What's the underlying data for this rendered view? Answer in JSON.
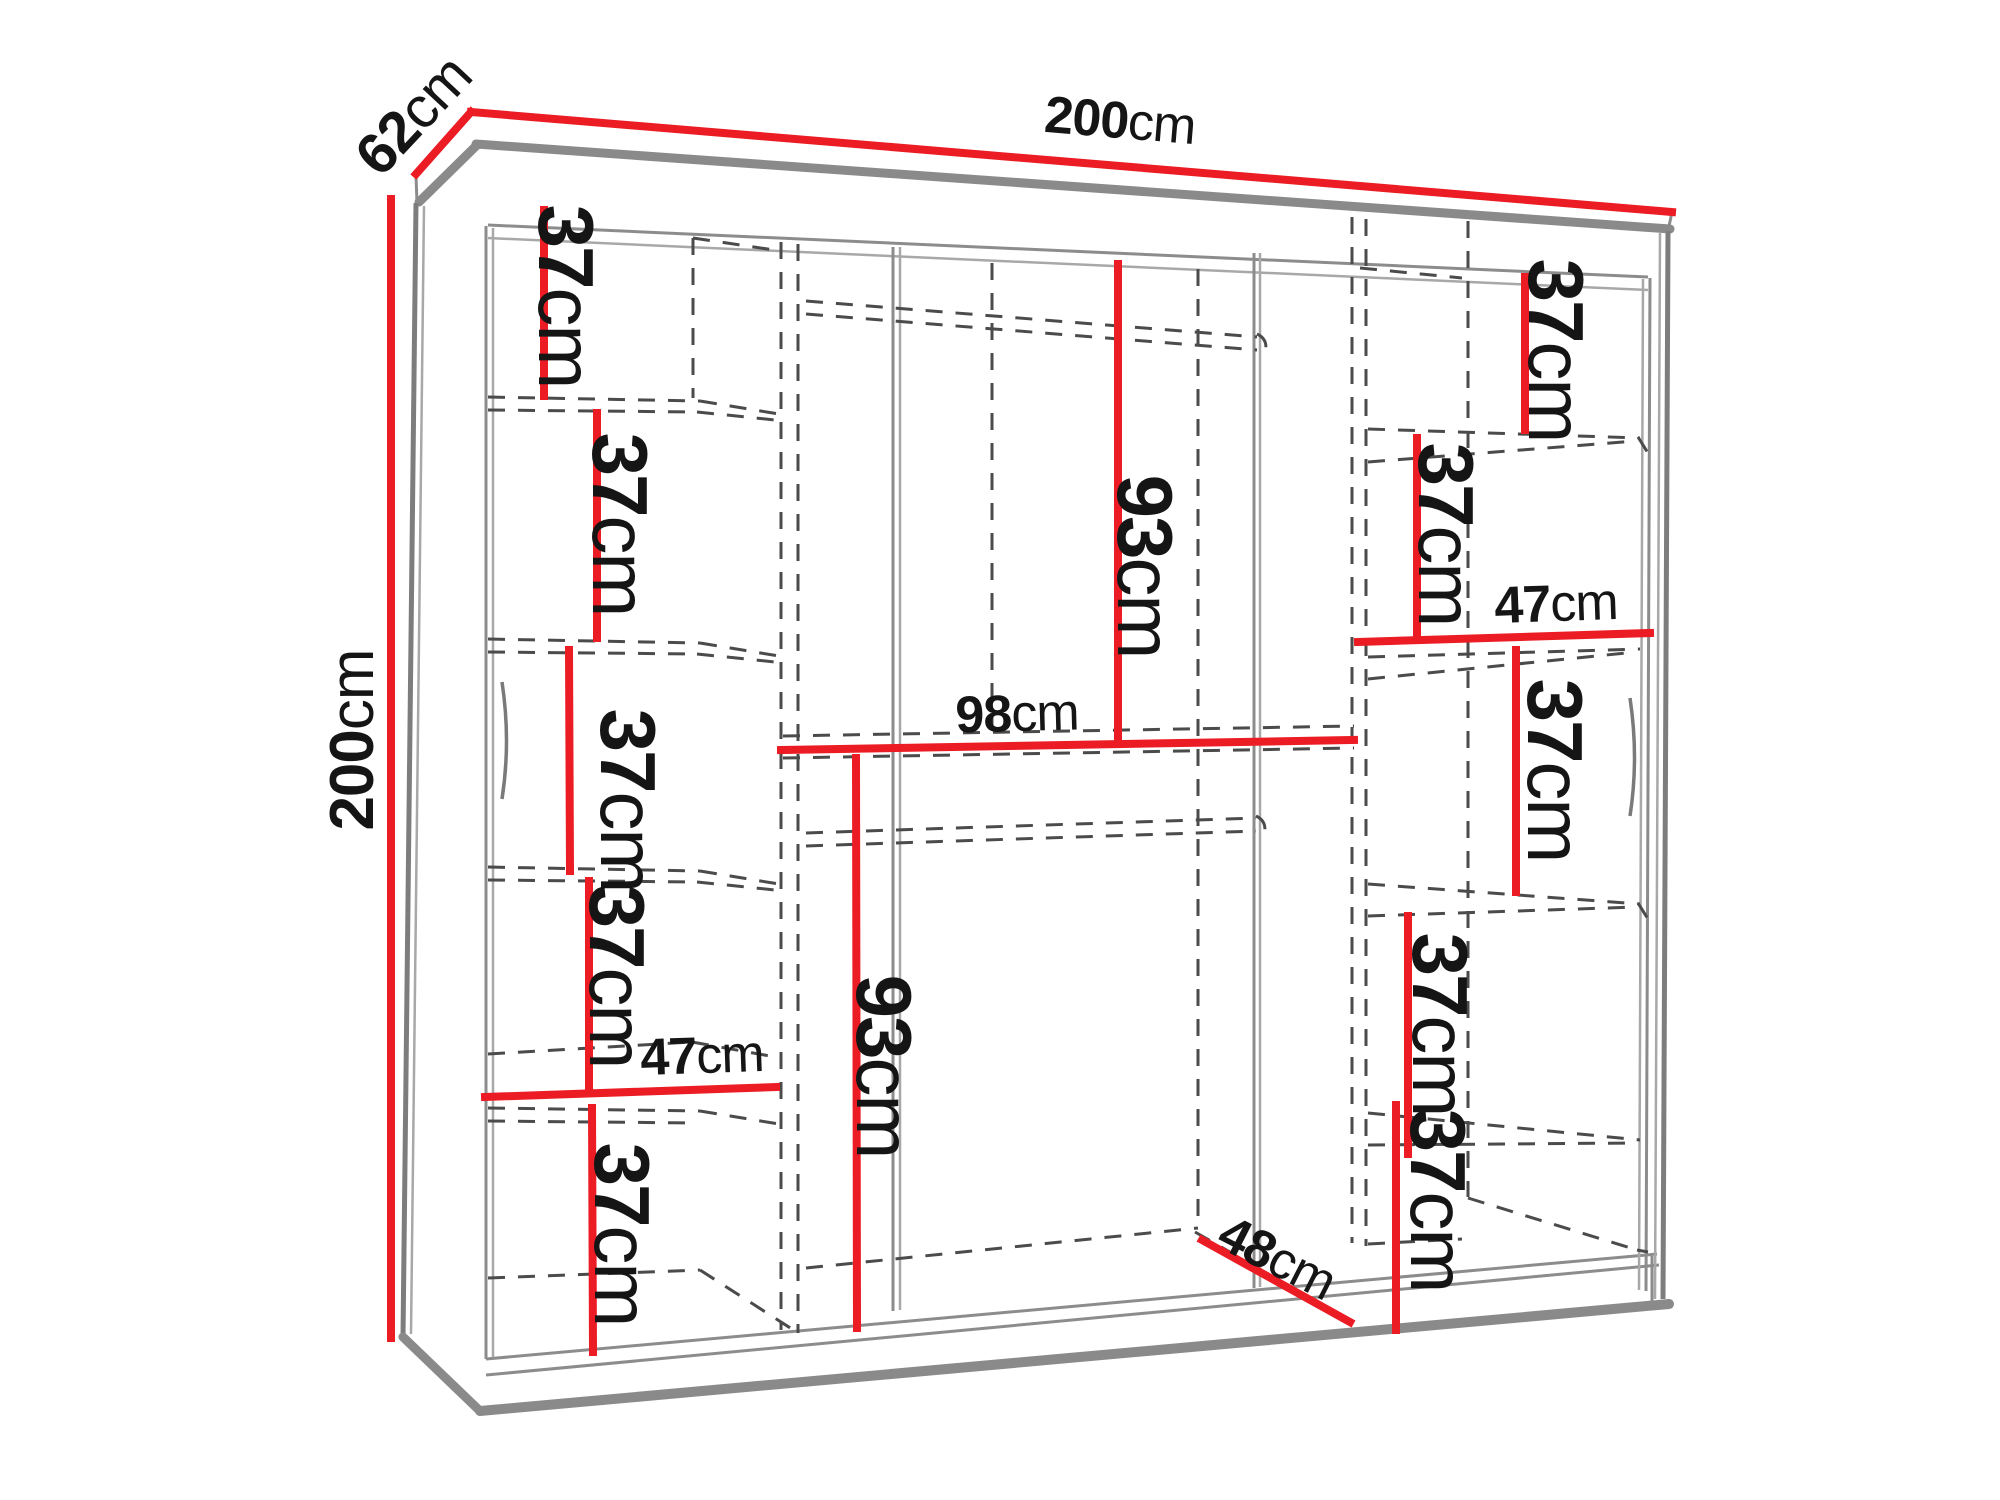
{
  "diagram": {
    "kind": "wardrobe dimension drawing",
    "colors": {
      "dimension_accent": "#ec1c24",
      "frame_gray": "#8a8a8a",
      "dashed_gray": "#4b4b4b",
      "text": "#151515",
      "background": "#ffffff"
    },
    "units": "cm"
  },
  "labels": [
    {
      "id": "overall-width",
      "value": "200",
      "unit": "cm"
    },
    {
      "id": "overall-depth",
      "value": "62",
      "unit": "cm"
    },
    {
      "id": "overall-height",
      "value": "200",
      "unit": "cm"
    },
    {
      "id": "left-shelf-1-height",
      "value": "37",
      "unit": "cm"
    },
    {
      "id": "left-shelf-2-height",
      "value": "37",
      "unit": "cm"
    },
    {
      "id": "left-shelf-3-height",
      "value": "37",
      "unit": "cm"
    },
    {
      "id": "left-shelf-4-height",
      "value": "37",
      "unit": "cm"
    },
    {
      "id": "left-column-width",
      "value": "47",
      "unit": "cm"
    },
    {
      "id": "left-shelf-5-height",
      "value": "37",
      "unit": "cm"
    },
    {
      "id": "middle-upper-height",
      "value": "93",
      "unit": "cm"
    },
    {
      "id": "middle-width",
      "value": "98",
      "unit": "cm"
    },
    {
      "id": "middle-lower-height",
      "value": "93",
      "unit": "cm"
    },
    {
      "id": "middle-floor-depth",
      "value": "48",
      "unit": "cm"
    },
    {
      "id": "right-shelf-1-height",
      "value": "37",
      "unit": "cm"
    },
    {
      "id": "right-shelf-2-height",
      "value": "37",
      "unit": "cm"
    },
    {
      "id": "right-column-width",
      "value": "47",
      "unit": "cm"
    },
    {
      "id": "right-shelf-3-height",
      "value": "37",
      "unit": "cm"
    },
    {
      "id": "right-shelf-4-height",
      "value": "37",
      "unit": "cm"
    },
    {
      "id": "right-shelf-5-height",
      "value": "37",
      "unit": "cm"
    }
  ]
}
